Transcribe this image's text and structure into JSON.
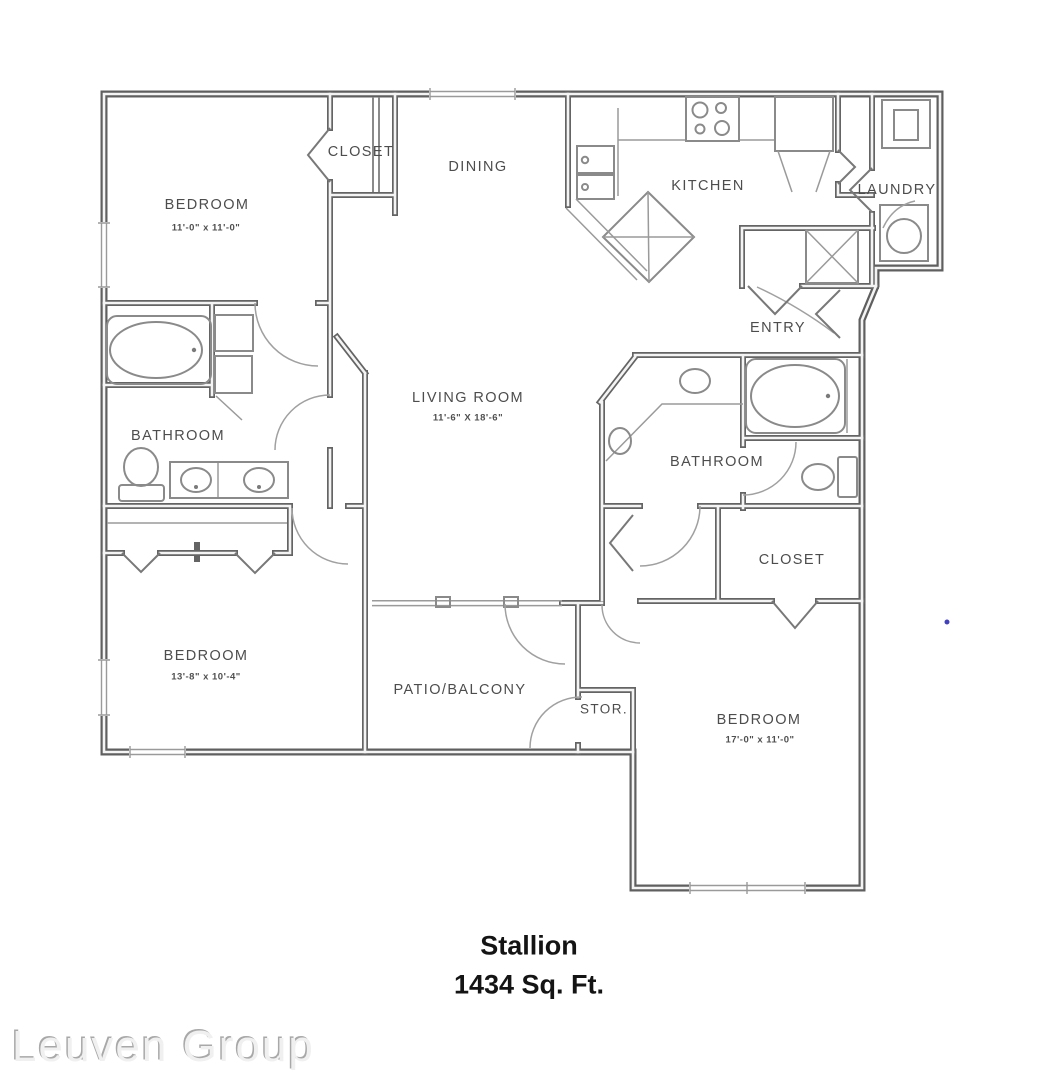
{
  "title": {
    "name": "Stallion",
    "area": "1434 Sq. Ft."
  },
  "watermark": {
    "text": "Leuven Group"
  },
  "rooms": {
    "bedroom1": {
      "label": "BEDROOM",
      "dims": "11'-0\" x 11'-0\""
    },
    "closet1": {
      "label": "CLOSET"
    },
    "dining": {
      "label": "DINING"
    },
    "kitchen": {
      "label": "KITCHEN"
    },
    "laundry": {
      "label": "LAUNDRY"
    },
    "entry": {
      "label": "ENTRY"
    },
    "bathroom1": {
      "label": "BATHROOM"
    },
    "living": {
      "label": "LIVING ROOM",
      "dims": "11'-6\" X 18'-6\""
    },
    "bathroom2": {
      "label": "BATHROOM"
    },
    "closet2": {
      "label": "CLOSET"
    },
    "bedroom2": {
      "label": "BEDROOM",
      "dims": "13'-8\" x 10'-4\""
    },
    "patio": {
      "label": "PATIO/BALCONY"
    },
    "storage": {
      "label": "STOR."
    },
    "bedroom3": {
      "label": "BEDROOM",
      "dims": "17'-0\" x 11'-0\""
    }
  },
  "fixtures": {
    "bathroom1": [
      "bathtub",
      "toilet",
      "double-sink-vanity",
      "linen-cabinets"
    ],
    "bathroom2": [
      "bathtub",
      "toilet",
      "double-sink-vanity",
      "linen-shelf"
    ],
    "kitchen": [
      "range-cooktop",
      "refrigerator",
      "double-sink",
      "island-counter",
      "pantry"
    ],
    "laundry": [
      "washer",
      "dryer"
    ],
    "utility": [
      "water-heater-closet"
    ],
    "patio": [
      "sliding-glass-door"
    ]
  },
  "colors": {
    "walls": "#5f5f5f",
    "fixtures": "#8a8a8a",
    "text": "#4d4d4d",
    "title_text": "#141414",
    "stray_mark": "#4040c0",
    "background": "#ffffff"
  }
}
